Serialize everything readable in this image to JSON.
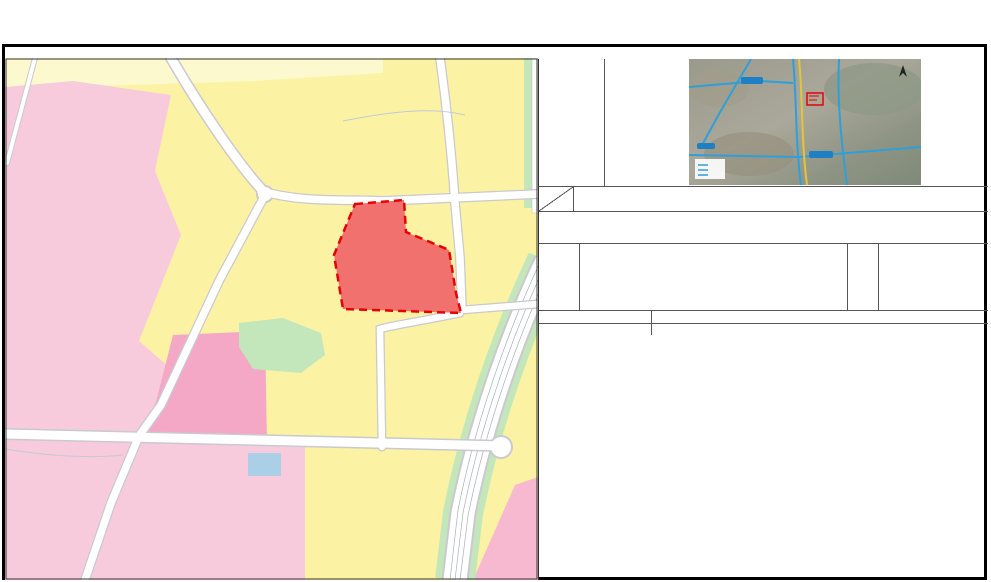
{
  "title": "贵阳市花溪区控制性详细规划（调整） —— 03-02-16、17地块图则",
  "image_panel": {
    "label": "调规地块影像图"
  },
  "table": {
    "corner": {
      "top": "类别",
      "bottom": "名称"
    },
    "headers": [
      "地块编号",
      "地块性质",
      "分类代码",
      "规划用地\n面积（ha）",
      "容积率",
      "绿地率\n（%）",
      "建筑密度\n（%）",
      "建筑限高\n（M）",
      "兼容建筑",
      "配套设施"
    ],
    "sections": [
      {
        "label": "原控规指标",
        "rows": [
          [
            "03-02-16(A)",
            "住宅用地",
            "R21",
            "0.18",
            "2.0",
            "30",
            "30",
            "25",
            "",
            ""
          ],
          [
            "03-02-17",
            "中小学用地",
            "A33",
            "1.24",
            "0.9",
            "35",
            "20",
            "20",
            "",
            ""
          ],
          [
            "",
            "",
            "",
            "",
            "",
            "",
            "",
            "",
            "",
            ""
          ],
          [
            "",
            "",
            "",
            "",
            "",
            "",
            "",
            "",
            "",
            ""
          ],
          [
            "",
            "",
            "",
            "",
            "",
            "",
            "",
            "",
            "",
            ""
          ],
          [
            "",
            "",
            "",
            "",
            "",
            "",
            "",
            "",
            "",
            ""
          ]
        ]
      },
      {
        "label": "调整后指标",
        "rows": [
          [
            "03-02-17\n（调）",
            "医院用地",
            "A51",
            "1.42",
            "3.0",
            "30",
            "50",
            "54",
            "",
            ""
          ],
          [
            "",
            "",
            "",
            "",
            "",
            "",
            "",
            "",
            "",
            ""
          ],
          [
            "",
            "",
            "",
            "",
            "",
            "",
            "",
            "",
            "",
            ""
          ],
          [
            "",
            "",
            "",
            "",
            "",
            "",
            "",
            "",
            "",
            ""
          ],
          [
            "",
            "",
            "",
            "",
            "",
            "",
            "",
            "",
            "",
            ""
          ],
          [
            "",
            "",
            "",
            "",
            "",
            "",
            "",
            "",
            "",
            ""
          ]
        ]
      }
    ]
  },
  "notes": {
    "label": "备注：",
    "lines": [
      "1、整体指标符合《贵阳市城市更新改造地块规划设计条件指引》相关规定；",
      "2、居住用地配套设施具体内容和规模需符合《城市居住区规划设计标准（GB 50180-2018）》及相关法律法规规定。"
    ]
  },
  "legend": {
    "label": "图例",
    "other_label": "其他图例",
    "swatches": [
      {
        "name": "hospital-land",
        "label": "医院用地",
        "color": "#F0716E",
        "type": "fill",
        "bold": true
      },
      {
        "name": "class2-residential-land",
        "label": "二类居住用地",
        "color": "#FFFF00",
        "type": "fill",
        "bold": false
      },
      {
        "name": "planning-boundary",
        "label": "规划范围",
        "type": "dashed",
        "bold": false
      }
    ],
    "facilities": [
      {
        "kind": "char-red",
        "glyph": "社",
        "label": "社区服务站"
      },
      {
        "kind": "char-red",
        "glyph": "文",
        "label": "文化活动站"
      },
      {
        "kind": "rect",
        "glyph": "",
        "label": "小型多功能运动场地"
      },
      {
        "kind": "char-red",
        "glyph": "老",
        "label": "老年人日间照料中心"
      },
      {
        "kind": "char-red",
        "glyph": "幼",
        "label": "幼儿园"
      }
    ],
    "utilities": [
      {
        "kind": "half-circle",
        "glyph": "",
        "label": "污水处理站"
      },
      {
        "kind": "recycle",
        "glyph": "※",
        "label": "再生资源回收点"
      },
      {
        "kind": "trash",
        "glyph": "",
        "label": "生活垃圾收集站"
      },
      {
        "kind": "toilet",
        "glyph": "",
        "label": "公共厕所"
      },
      {
        "kind": "road",
        "glyph": "",
        "label": "弹性路网"
      }
    ]
  },
  "footer": {
    "rows": [
      {
        "label": "编制单位",
        "value": "北京清华同衡规划设计研究院有限公司"
      },
      {
        "label": "编制时间",
        "value": "2024年4月"
      }
    ]
  },
  "map": {
    "plot_label": "03-02-17（调）",
    "colors": {
      "residential_yellow": "#FBF3A3",
      "pale_yellow": "#FDF9CE",
      "pink": "#F8CBDC",
      "dark_pink": "#F5A8C6",
      "hospital_red": "#F0716E",
      "green": "#C3E6BB",
      "blue": "#AACFE6",
      "boundary_red": "#E60202"
    },
    "labels": [
      {
        "t": "筑",
        "x": 306,
        "y": 76,
        "cls": "road"
      },
      {
        "t": "徐",
        "x": 438,
        "y": 80,
        "cls": "road"
      },
      {
        "t": "溪",
        "x": 444,
        "y": 126,
        "cls": "road"
      },
      {
        "t": "冲",
        "x": 446,
        "y": 166,
        "cls": "road"
      },
      {
        "t": "南",
        "x": 451,
        "y": 223,
        "cls": "road"
      },
      {
        "t": "成",
        "x": 291,
        "y": 197,
        "cls": "road"
      },
      {
        "t": "巷",
        "x": 418,
        "y": 199,
        "cls": "road"
      },
      {
        "t": "晖",
        "x": 208,
        "y": 292,
        "cls": "road"
      },
      {
        "t": "巷",
        "x": 496,
        "y": 306,
        "cls": "road"
      },
      {
        "t": "柳",
        "x": 374,
        "y": 342,
        "cls": "road"
      },
      {
        "t": "杨",
        "x": 377,
        "y": 411,
        "cls": "road"
      },
      {
        "t": "学",
        "x": 68,
        "y": 438,
        "cls": "road"
      },
      {
        "t": "上",
        "x": 281,
        "y": 441,
        "cls": "road"
      },
      {
        "t": "路",
        "x": 431,
        "y": 444,
        "cls": "road"
      },
      {
        "t": "路",
        "x": 113,
        "y": 503,
        "cls": "road"
      },
      {
        "t": "溪",
        "x": 507,
        "y": 469,
        "cls": "road"
      },
      {
        "t": "路",
        "x": 494,
        "y": 531,
        "cls": "road"
      },
      {
        "t": "3m",
        "x": 456,
        "y": 99,
        "cls": "dim"
      },
      {
        "t": "3m",
        "x": 132,
        "y": 479,
        "cls": "dim"
      },
      {
        "t": "5m",
        "x": 505,
        "y": 372,
        "cls": "dim"
      },
      {
        "t": "50m",
        "x": 495,
        "y": 388,
        "cls": "dimlg"
      },
      {
        "t": "镇南排水干线",
        "x": 378,
        "y": 103,
        "cls": "water"
      },
      {
        "t": "农院排水干线",
        "x": 64,
        "y": 453,
        "cls": "water"
      },
      {
        "t": "轨道交通3号线",
        "x": 394,
        "y": 468,
        "cls": "rail"
      }
    ],
    "icons": [
      {
        "k": "char-red",
        "c": "社",
        "x": 296,
        "y": 371
      },
      {
        "k": "char-red",
        "c": "文",
        "x": 308,
        "y": 371
      },
      {
        "k": "rect",
        "c": "",
        "x": 320,
        "y": 371
      },
      {
        "k": "char-red",
        "c": "老",
        "x": 333,
        "y": 371
      },
      {
        "k": "recycle",
        "c": "※",
        "x": 296,
        "y": 385
      },
      {
        "k": "trash",
        "c": "",
        "x": 308,
        "y": 385
      },
      {
        "k": "toilet",
        "c": "",
        "x": 320,
        "y": 385
      },
      {
        "k": "char-red",
        "c": "幼",
        "x": 283,
        "y": 414
      },
      {
        "k": "half-circle",
        "c": "",
        "x": 352,
        "y": 419
      }
    ]
  }
}
